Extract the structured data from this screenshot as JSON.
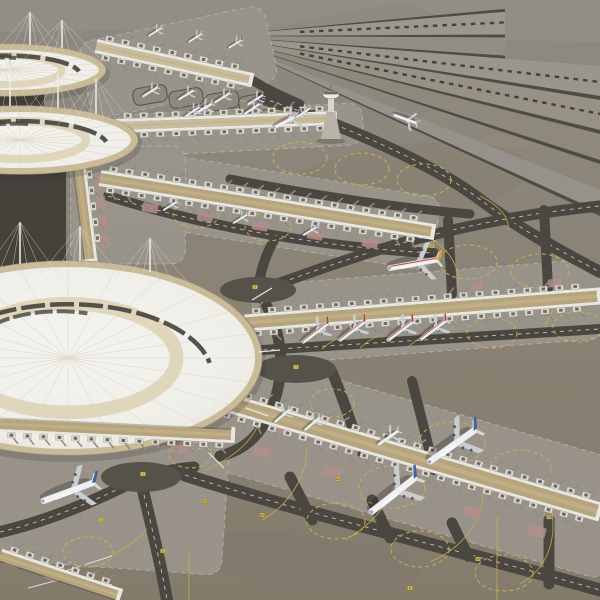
{
  "meta": {
    "subject": "3D render of an airport terminal complex model, aerial oblique view",
    "style": "grey-tan tarmac, three circular white tensile-roof terminals, tan gate piers, parallel runways upper right"
  },
  "palette": {
    "ground_top": "#8e8a82",
    "ground_mid": "#8a8376",
    "ground_bot": "#837b6c",
    "backdrop": "#918e87",
    "edge": "#4f4c45",
    "r1": "#9c978d",
    "r2": "#938e84",
    "r3": "#9b968c",
    "r4": "#979186",
    "r5": "#8f897d",
    "r6": "#96918a",
    "asphalt": "#4a4640",
    "asphalt_dark": "#45423c",
    "apron": "#9a958b",
    "apron_edge": "#c6c2b8",
    "pier_roof": "#b5a47c",
    "pier_roof_light": "#c9bd9e",
    "pier_side": "#e9e7e1",
    "module": "#dcd9d1",
    "module_dark": "#6e6a61",
    "dome_hi": "#f4f3ee",
    "dome_lo": "#e2ded2",
    "dome_line": "#dbd7cb",
    "rim_beige": "#c7b794",
    "cream_ring": "#ddd3b6",
    "dark_band": "#46453f",
    "rose": "#b18e88",
    "pad_dark": "#55524a",
    "yellow": "#ccb44f",
    "yellow_sign": "#d9c04f",
    "sign_text": "#3f3a1e",
    "white_mark": "#d8d5cd",
    "fuselage": "#eef0f1",
    "wing": "#c9cdd0",
    "tailplane": "#d4d7d9",
    "stripe_red": "#c0473a",
    "shadow": "rgba(32,30,26,0.30)",
    "dot_row": "#3a3833",
    "tower_shaft": "#d9d6cd",
    "tower_base": "#b9b4a8"
  },
  "backdrop_poly": "0,0 600,0 600,42 500,40 403,2 270,27 0,32",
  "fan": {
    "vp": [
      213,
      36
    ],
    "groups": [
      {
        "endX": 505,
        "strips": [
          [
            0,
            4,
            "edge"
          ],
          [
            4,
            34,
            "r1"
          ],
          [
            34,
            38,
            "edge"
          ],
          [
            38,
            62,
            "r2"
          ],
          [
            62,
            66,
            "edge"
          ]
        ]
      },
      {
        "endX": 600,
        "strips": [
          [
            66,
            96,
            "r3"
          ],
          [
            96,
            100,
            "edge"
          ],
          [
            100,
            130,
            "r4"
          ],
          [
            130,
            134,
            "edge"
          ],
          [
            134,
            160,
            "r5"
          ],
          [
            160,
            164,
            "edge"
          ],
          [
            190,
            212,
            "r6"
          ],
          [
            212,
            216,
            "edge"
          ]
        ]
      }
    ],
    "dotted": [
      [
        18,
        505
      ],
      [
        82,
        600
      ],
      [
        114,
        600
      ]
    ]
  },
  "blotches": [
    [
      380,
      60,
      40,
      7,
      -12,
      "#a59878",
      0.16
    ],
    [
      480,
      95,
      55,
      8,
      -9,
      "#a59878",
      0.16
    ],
    [
      520,
      140,
      45,
      8,
      -6,
      "#a59878",
      0.16
    ],
    [
      430,
      120,
      35,
      6,
      -9,
      "#a59878",
      0.14
    ],
    [
      400,
      185,
      130,
      40,
      -8,
      "#867e6f",
      0.45
    ],
    [
      500,
      390,
      90,
      20,
      3,
      "#857d6e",
      0.35
    ],
    [
      120,
      320,
      60,
      16,
      0,
      "#857d6e",
      0.3
    ],
    [
      300,
      560,
      120,
      26,
      6,
      "#7f7769",
      0.3
    ]
  ],
  "dark_areas": [
    "0,148 66,150 66,266 0,296",
    "0,84 44,90 44,122 0,128"
  ],
  "aprons": [
    [
      178,
      62,
      190,
      78,
      -12
    ],
    [
      238,
      130,
      250,
      42,
      -3
    ],
    [
      268,
      208,
      340,
      74,
      9
    ],
    [
      428,
      312,
      350,
      80,
      -4.5
    ],
    [
      408,
      462,
      440,
      120,
      16
    ],
    [
      108,
      505,
      235,
      125,
      4
    ],
    [
      128,
      205,
      115,
      118,
      0
    ]
  ],
  "gray_pads": [
    [
      150,
      95,
      34,
      17,
      -10
    ],
    [
      186,
      98,
      34,
      17,
      -10
    ],
    [
      222,
      101,
      34,
      17,
      -10
    ],
    [
      256,
      103,
      34,
      17,
      -10
    ]
  ],
  "lanes": [
    [
      "M262,98 C340,124 430,162 478,198 C520,230 570,256 600,272",
      12,
      1
    ],
    [
      "M258,291 C340,262 440,222 600,206",
      11,
      1
    ],
    [
      "M246,351 L600,329",
      10,
      1
    ],
    [
      "M185,475 C300,512 450,548 600,590",
      13,
      1
    ],
    [
      "M140,478 C150,520 160,560 167,600",
      12,
      1
    ],
    [
      "M0,532 C48,521 100,499 140,478",
      12,
      1
    ],
    [
      "M258,291 C284,330 290,378 264,424 C252,444 236,452 220,456",
      11,
      0
    ],
    [
      "M108,196 C210,228 330,248 434,253",
      10,
      1
    ],
    [
      "M230,179 C320,196 400,208 470,214",
      9,
      0
    ],
    [
      "M332,372 C344,400 352,428 362,452",
      11,
      0
    ],
    [
      "M412,381 C420,412 428,444 434,470",
      10,
      0
    ],
    [
      "M448,220 L452,294",
      10,
      0
    ],
    [
      "M544,210 L548,288",
      10,
      0
    ],
    [
      "M290,477 L312,520",
      11,
      0
    ],
    [
      "M372,500 L390,538",
      11,
      0
    ],
    [
      "M452,523 L468,556",
      11,
      0
    ],
    [
      "M549,520 L549,584",
      11,
      0
    ],
    [
      "M252,80 C268,90 286,98 300,104",
      9,
      0
    ],
    [
      "M258,291 C260,272 266,254 274,240",
      10,
      0
    ],
    [
      "M140,478 C160,472 178,468 194,467",
      11,
      0
    ]
  ],
  "hold_pads": [
    [
      258,
      290,
      38,
      13
    ],
    [
      296,
      369,
      40,
      14
    ],
    [
      141,
      477,
      40,
      15
    ]
  ],
  "yellow_circles": [
    [
      300,
      158,
      27,
      16
    ],
    [
      362,
      169,
      27,
      16
    ],
    [
      424,
      180,
      27,
      16
    ],
    [
      196,
      214,
      23,
      14
    ],
    [
      268,
      227,
      23,
      14
    ],
    [
      468,
      262,
      29,
      17
    ],
    [
      540,
      271,
      29,
      17
    ],
    [
      492,
      333,
      25,
      15
    ],
    [
      578,
      327,
      25,
      15
    ],
    [
      452,
      443,
      33,
      21
    ],
    [
      392,
      487,
      33,
      21
    ],
    [
      520,
      469,
      31,
      19
    ],
    [
      336,
      521,
      29,
      18
    ],
    [
      420,
      549,
      29,
      18
    ],
    [
      504,
      573,
      29,
      18
    ],
    [
      88,
      552,
      25,
      15
    ],
    [
      190,
      455,
      21,
      13
    ],
    [
      332,
      403,
      22,
      14
    ]
  ],
  "yellow_guides": [
    "M262,520 C290,505 310,472 306,442",
    "M345,540 C380,520 400,490 396,462",
    "M430,562 C470,545 488,510 482,480",
    "M520,584 C548,568 556,540 552,512",
    "M497,518 L497,600",
    "M189,552 L189,600",
    "M205,470 C240,455 262,432 260,410",
    "M322,349 C330,342 337,338 344,336",
    "M360,348 C368,341 374,337 381,335",
    "M408,347 C416,340 422,336 429,334",
    "M452,330 C458,314 464,305 470,301",
    "M545,326 C551,312 556,304 561,300",
    "M100,560 C120,552 138,541 147,529",
    "M480,196 C500,206 510,218 508,230",
    "M240,100 C262,108 281,112 296,112",
    "M430,238 C450,250 460,268 458,284"
  ],
  "white_guides": [
    "M112,556 L62,572 L28,561",
    "M112,585 L62,572",
    "M28,588 L70,577"
  ],
  "rose_pads": [
    [
      150,
      208,
      16,
      9,
      10
    ],
    [
      205,
      217,
      16,
      9,
      10
    ],
    [
      260,
      226,
      16,
      9,
      10
    ],
    [
      315,
      235,
      16,
      9,
      10
    ],
    [
      370,
      243,
      16,
      9,
      10
    ],
    [
      300,
      318,
      15,
      8,
      -4
    ],
    [
      340,
      315,
      15,
      8,
      -4
    ],
    [
      385,
      312,
      15,
      8,
      -4
    ],
    [
      430,
      309,
      15,
      8,
      -4
    ],
    [
      475,
      306,
      15,
      8,
      -4
    ],
    [
      520,
      303,
      15,
      8,
      -4
    ],
    [
      560,
      300,
      15,
      8,
      -4
    ],
    [
      480,
      287,
      14,
      8,
      -4
    ],
    [
      555,
      283,
      14,
      8,
      -4
    ],
    [
      280,
      428,
      18,
      10,
      16
    ],
    [
      350,
      448,
      18,
      10,
      16
    ],
    [
      420,
      468,
      18,
      10,
      16
    ],
    [
      490,
      488,
      18,
      10,
      16
    ],
    [
      555,
      507,
      18,
      10,
      16
    ],
    [
      262,
      452,
      18,
      10,
      16
    ],
    [
      332,
      472,
      18,
      10,
      16
    ],
    [
      402,
      492,
      18,
      10,
      16
    ],
    [
      472,
      512,
      18,
      10,
      16
    ],
    [
      537,
      531,
      18,
      10,
      16
    ],
    [
      30,
      440,
      16,
      9,
      2
    ],
    [
      80,
      443,
      16,
      9,
      2
    ],
    [
      130,
      446,
      16,
      9,
      2
    ],
    [
      180,
      449,
      16,
      9,
      2
    ],
    [
      97,
      162,
      9,
      13,
      -8
    ],
    [
      99,
      182,
      9,
      13,
      -8
    ],
    [
      101,
      202,
      9,
      13,
      -8
    ],
    [
      103,
      222,
      9,
      13,
      -8
    ],
    [
      105,
      242,
      9,
      13,
      -8
    ],
    [
      12,
      562,
      14,
      9,
      18
    ],
    [
      52,
      576,
      14,
      9,
      18
    ]
  ],
  "piers": [
    {
      "x1": 96,
      "y1": 46,
      "x2": 252,
      "y2": 80,
      "w": 8,
      "sides": "both",
      "roof": "pier_roof_light",
      "front": 0
    },
    {
      "x1": 116,
      "y1": 126,
      "x2": 336,
      "y2": 118,
      "w": 8,
      "sides": "both",
      "roof": "pier_roof_light",
      "front": 0
    },
    {
      "x1": 100,
      "y1": 178,
      "x2": 434,
      "y2": 232,
      "w": 10,
      "sides": "both",
      "roof": "pier_roof",
      "front": 0
    },
    {
      "x1": 245,
      "y1": 323,
      "x2": 600,
      "y2": 296,
      "w": 11,
      "sides": "both",
      "roof": "pier_roof",
      "front": 0
    },
    {
      "x1": 218,
      "y1": 400,
      "x2": 600,
      "y2": 512,
      "w": 13,
      "sides": "both",
      "roof": "pier_roof",
      "front": 0
    },
    {
      "x1": 76,
      "y1": 148,
      "x2": 90,
      "y2": 262,
      "w": 9,
      "sides": "north",
      "roof": "pier_roof",
      "front": 0
    },
    {
      "x1": 0,
      "y1": 556,
      "x2": 120,
      "y2": 596,
      "w": 9,
      "sides": "north",
      "roof": "pier_roof",
      "front": 0
    },
    {
      "x1": 0,
      "y1": 424,
      "x2": 234,
      "y2": 435,
      "w": 10,
      "sides": "south",
      "roof": "pier_roof",
      "front": 1
    }
  ],
  "terminals": [
    {
      "cx": 6,
      "cy": 70,
      "rx": 100,
      "ry": 26,
      "masts": [
        [
          30,
          45,
          12
        ],
        [
          62,
          48,
          20
        ]
      ]
    },
    {
      "cx": 20,
      "cy": 140,
      "rx": 118,
      "ry": 34,
      "masts": [
        [
          58,
          108,
          70
        ],
        [
          96,
          114,
          78
        ],
        [
          10,
          106,
          60
        ]
      ]
    },
    {
      "cx": 68,
      "cy": 358,
      "rx": 194,
      "ry": 97,
      "masts": [
        [
          80,
          261,
          226
        ],
        [
          150,
          272,
          238
        ],
        [
          20,
          264,
          222
        ]
      ],
      "spars": [
        [
          252,
          300,
          272,
          288
        ],
        [
          258,
          352,
          280,
          350
        ],
        [
          246,
          408,
          268,
          416
        ],
        [
          208,
          452,
          224,
          468
        ]
      ]
    }
  ],
  "tower": {
    "x": 331,
    "base_y": 139,
    "cab_y": 95,
    "tip_y": 84
  },
  "aircraft": [
    [
      405,
      119,
      26,
      200,
      "#a8a8a6",
      ""
    ],
    [
      287,
      121,
      30,
      152,
      "#4a66a8",
      ""
    ],
    [
      203,
      109,
      22,
      150,
      "#c6c3bb",
      ""
    ],
    [
      155,
      32,
      16,
      148,
      "#c6c3bb",
      ""
    ],
    [
      195,
      38,
      16,
      148,
      "#c6c3bb",
      ""
    ],
    [
      235,
      44,
      16,
      148,
      "#a84c3c",
      ""
    ],
    [
      150,
      92,
      19,
      148,
      "#c9c5bd",
      ""
    ],
    [
      186,
      95,
      19,
      148,
      "#a84c3c",
      ""
    ],
    [
      222,
      98,
      19,
      148,
      "#d3b84a",
      ""
    ],
    [
      255,
      100,
      19,
      148,
      "#8fa0ac",
      ""
    ],
    [
      192,
      112,
      18,
      146,
      "#c9c5bd",
      ""
    ],
    [
      252,
      109,
      20,
      146,
      "#4a66a8",
      ""
    ],
    [
      303,
      113,
      18,
      146,
      "#d3b84a",
      ""
    ],
    [
      170,
      206,
      17,
      148,
      "#b9b5ad",
      ""
    ],
    [
      240,
      219,
      17,
      148,
      "#b9b5ad",
      ""
    ],
    [
      310,
      231,
      17,
      148,
      "#4a66a8",
      ""
    ],
    [
      413,
      264,
      52,
      170,
      "#e8a132",
      "s4"
    ],
    [
      315,
      333,
      33,
      143,
      "#9c4a3e",
      "s"
    ],
    [
      352,
      331,
      33,
      143,
      "#9c4a3e",
      "s"
    ],
    [
      400,
      331,
      33,
      143,
      "#9c4a3e",
      "s"
    ],
    [
      433,
      330,
      33,
      143,
      "#9c4a3e",
      "s"
    ],
    [
      282,
      416,
      21,
      140,
      "#c9c5bd",
      ""
    ],
    [
      312,
      424,
      21,
      140,
      "#c9c5bd",
      ""
    ],
    [
      388,
      438,
      26,
      145,
      "#b9b5ad",
      ""
    ],
    [
      452,
      446,
      60,
      145,
      "#41619f",
      "4"
    ],
    [
      393,
      495,
      60,
      142,
      "#41619f",
      "4"
    ],
    [
      68,
      492,
      58,
      160,
      "#41619f",
      "4"
    ]
  ],
  "signs": [
    [
      255,
      287,
      "K"
    ],
    [
      296,
      367,
      "J"
    ],
    [
      143,
      474,
      "J"
    ],
    [
      163,
      551,
      "F"
    ],
    [
      205,
      501,
      "F5"
    ],
    [
      262,
      515,
      "E2"
    ],
    [
      410,
      588,
      "D"
    ],
    [
      549,
      517,
      "C4"
    ],
    [
      338,
      479,
      "E4"
    ],
    [
      101,
      520,
      "G"
    ],
    [
      478,
      559,
      "D2"
    ],
    [
      432,
      246,
      "B"
    ]
  ]
}
